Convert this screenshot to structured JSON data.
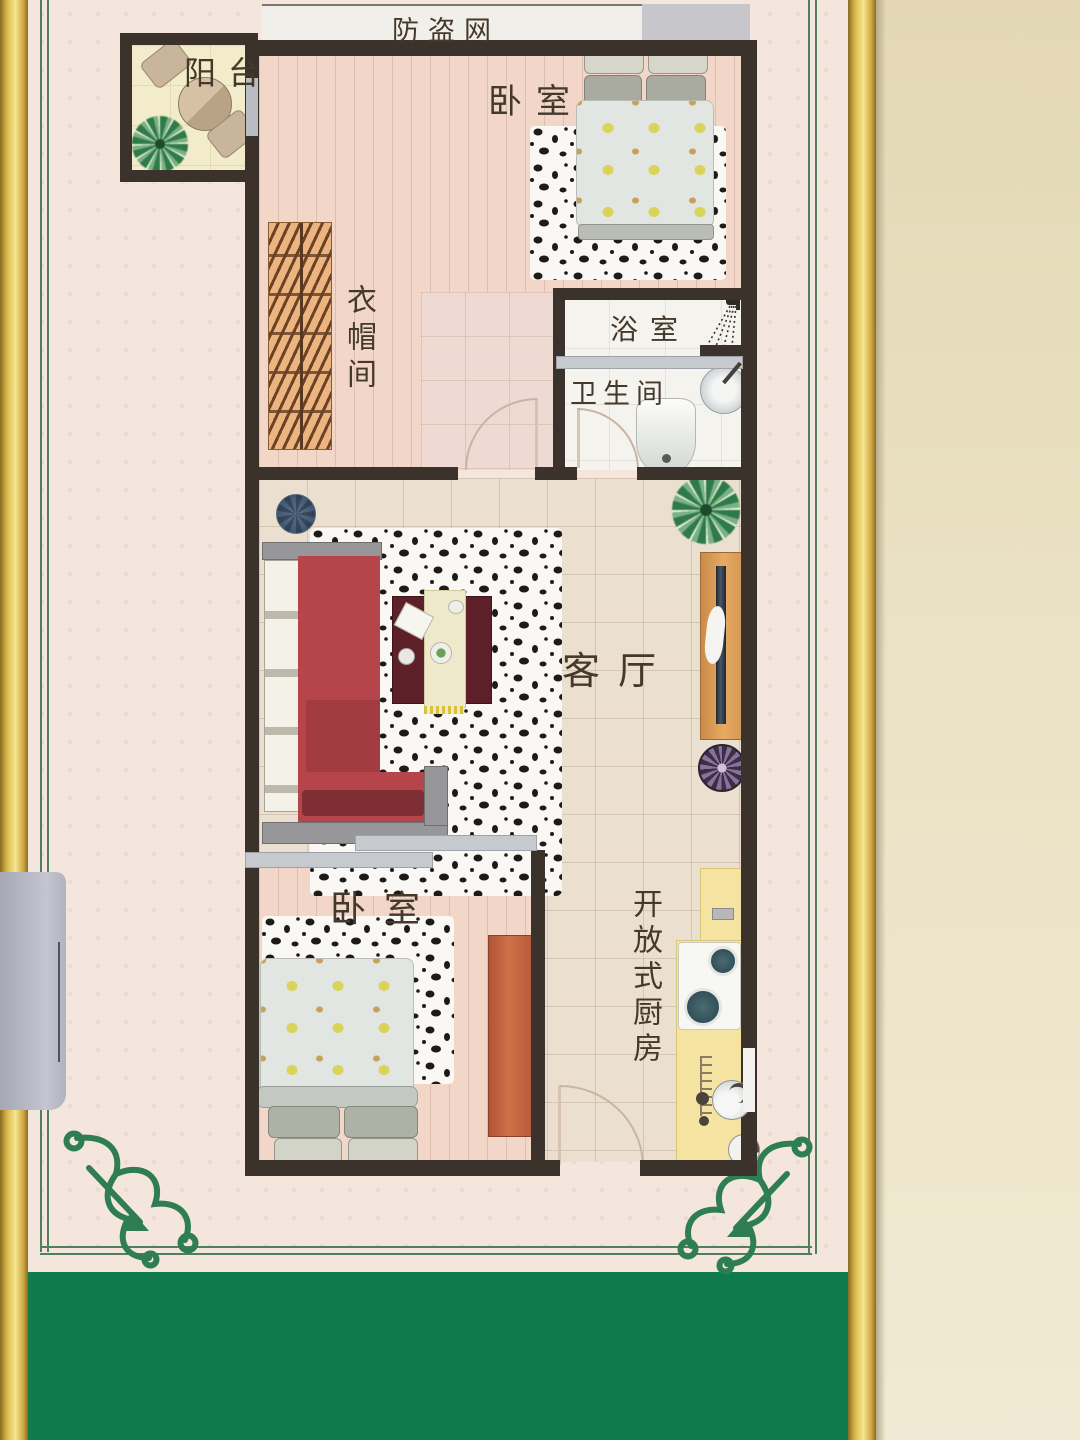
{
  "poster": {
    "security_strip_label": "防盗网",
    "rooms": {
      "balcony": "阳台",
      "bedroom_top": "卧室",
      "bathroom": "浴室",
      "toilet": "卫生间",
      "cloakroom": "衣帽间",
      "living_room": "客厅",
      "kitchen": "开放式厨房",
      "bedroom_bottom": "卧室"
    },
    "colors": {
      "green_band": "#0f7a4c",
      "border_green": "#4f7f5c",
      "gold_frame": "#d9b84a",
      "wall_dark": "#3a322b",
      "plank_pink": "#f2d7c8",
      "tile_beige": "#ebdfcf",
      "bath_white": "#f5f3ee",
      "counter_yellow": "#f5e3a2",
      "sofa_red": "#b5444b",
      "wardrobe_orange": "#c2603e",
      "cabinet_tan": "#dd9e5a"
    }
  }
}
